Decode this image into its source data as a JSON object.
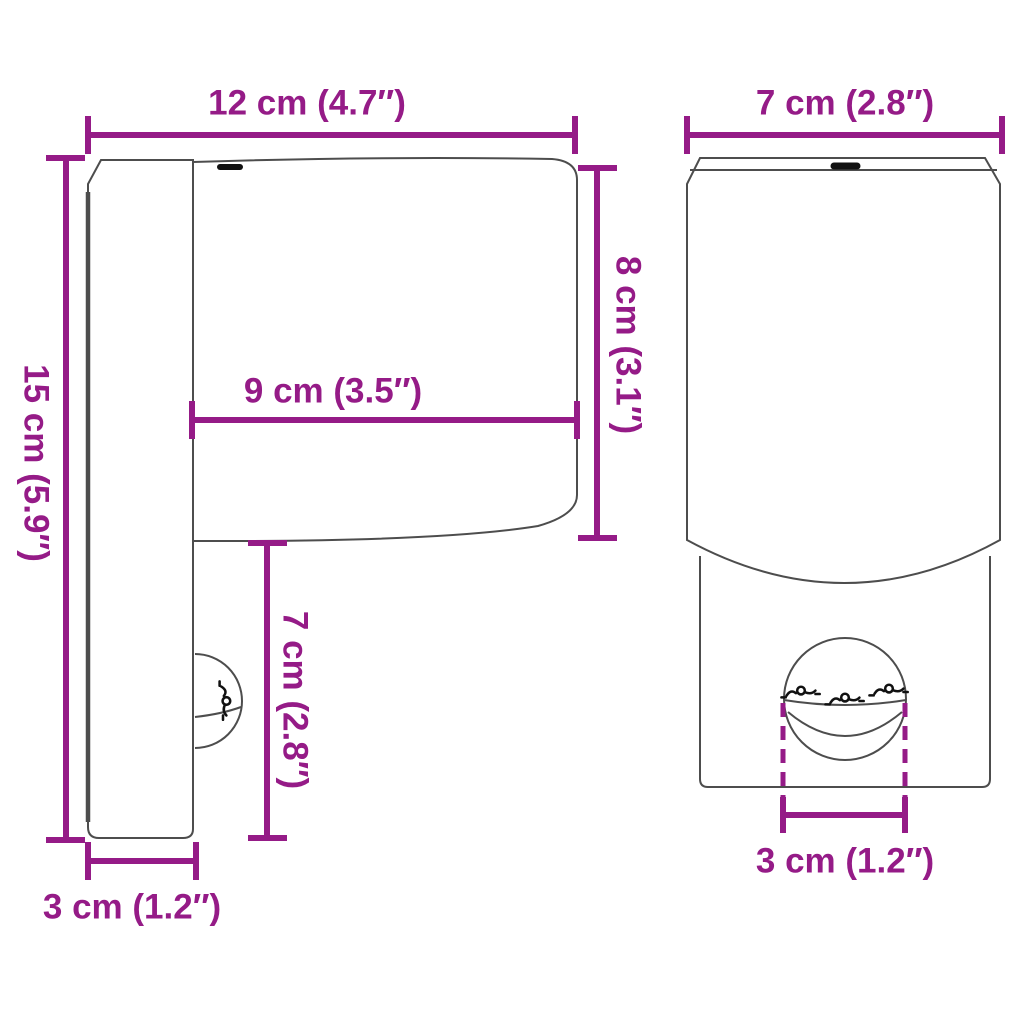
{
  "colors": {
    "dimension": "#951B87",
    "outline": "#4D4D4D",
    "detail": "#111111",
    "bg": "#FFFFFF"
  },
  "labels": {
    "side_width": "12 cm (4.7″)",
    "side_height": "15 cm (5.9″)",
    "head_height": "8 cm (3.1″)",
    "head_depth": "9 cm (3.5″)",
    "lower_height": "7 cm (2.8″)",
    "plate_depth": "3 cm (1.2″)",
    "front_width": "7 cm (2.8″)",
    "sensor_width": "3 cm (1.2″)"
  }
}
